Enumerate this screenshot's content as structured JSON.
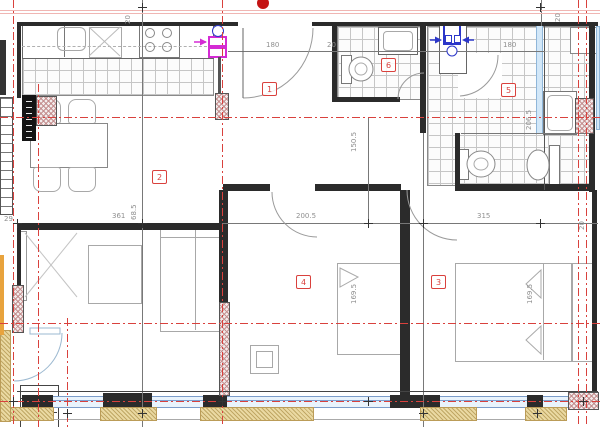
{
  "title": "apartment-floor-plan",
  "room_labels": {
    "r1": "1",
    "r2": "2",
    "r3": "3",
    "r4": "4",
    "r5": "5",
    "r6": "6"
  },
  "dims": {
    "top_left_20": "20",
    "entrance_180": "180",
    "hall_20": "20",
    "bath_180": "180",
    "top_right_20": "20",
    "hall_150_5": "150.5",
    "bath_206_5": "206.5",
    "left_29": "29",
    "living_361": "361",
    "living_68_5": "68.5",
    "hall_200_5": "200.5",
    "hall_315": "315",
    "right_20": "20",
    "bed4_169_5": "169.5",
    "bed3_169_5": "169.5"
  },
  "colors": {
    "wall": "#2b2b2b",
    "axis_red": "#d9413d",
    "highlight_magenta": "#d42bd4",
    "highlight_blue": "#2b36c9",
    "window_blue": "#7da0d0",
    "insulation_tan": "#ead9a2"
  }
}
